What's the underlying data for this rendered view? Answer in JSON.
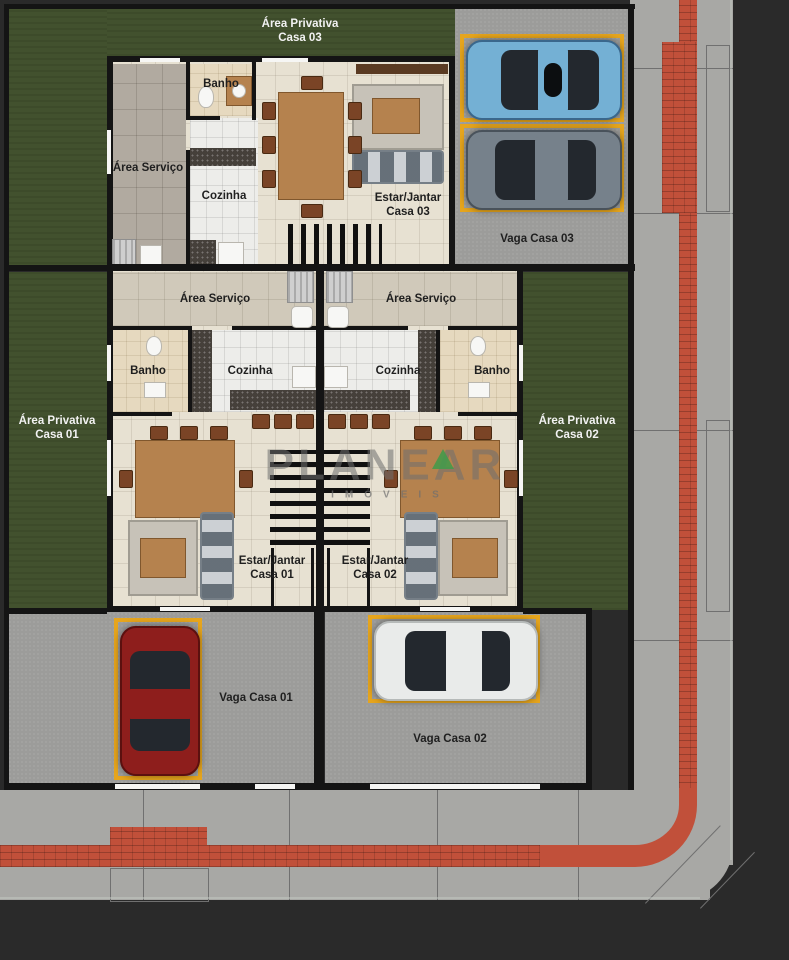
{
  "labels": {
    "area_privativa": "Área Privativa",
    "casa_01": "Casa 01",
    "casa_02": "Casa 02",
    "casa_03": "Casa 03",
    "area_servico": "Área Serviço",
    "banho": "Banho",
    "cozinha": "Cozinha",
    "estar_jantar": "Estar/Jantar",
    "vaga_casa_01": "Vaga Casa 01",
    "vaga_casa_02": "Vaga Casa 02",
    "vaga_casa_03": "Vaga Casa 03"
  },
  "watermark": {
    "brand": "PLANEAR",
    "subtitle": "IMÓVEIS"
  },
  "colors": {
    "asphalt": "#2a2a2a",
    "sidewalk": "#a8a8a5",
    "sidewalk_line": "#707070",
    "lawn": "#42512e",
    "wall": "#141414",
    "floor_tan": "#e7e1d2",
    "tile_white": "#ededea",
    "tile_gray": "#b1aaa0",
    "servico_tile": "#d0c9ba",
    "banho_floor": "#e6d9bf",
    "parking": "#9c9c9a",
    "vaga_box": "#e6a51d",
    "red_path": "#c1503a",
    "granite": "#45403a",
    "wood": "#b5824e",
    "chair": "#7a4426",
    "sofa": "#9aa3ab",
    "rug": "#c7c2b8",
    "stairs": "#101010",
    "machine": "#cfcfcf",
    "white_fixture": "#f7f7f5",
    "glass": "#23282e",
    "car_blue": "#74b0d4",
    "car_gray": "#76818b",
    "car_red": "#8e1e1c",
    "car_white": "#e9ebea",
    "label_dark": "#1f1f1f",
    "label_light": "#f2f2f2",
    "watermark_gray": "#6f6f6f",
    "watermark_green": "#3f9b4a"
  }
}
